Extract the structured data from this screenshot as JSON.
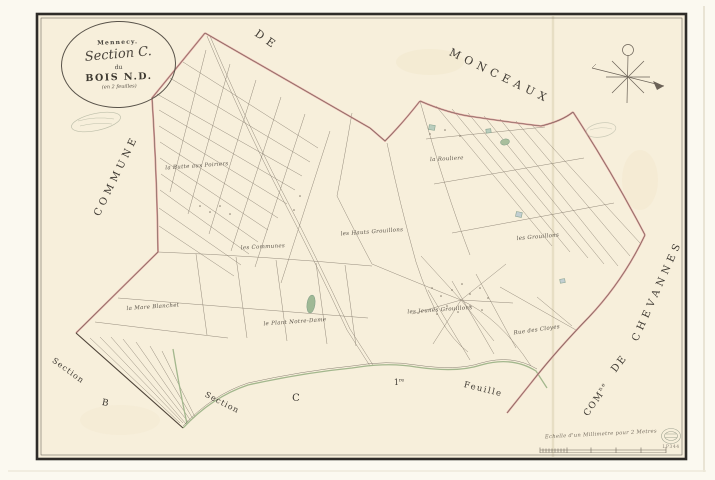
{
  "cartouche": {
    "commune": "Mennecy.",
    "section": "Section C.",
    "du": "du",
    "name": "BOIS N.D.",
    "note": "(en 2 feuilles)"
  },
  "neighbors": {
    "de_top": "DE",
    "monceaux": "MONCEAUX",
    "commune": "COMMUNE",
    "chevannes": "CHEVANNES",
    "de_right": "DE",
    "com_abbr": "COM",
    "com_sup": "ne"
  },
  "sections": {
    "section_b_word": "Section",
    "section_b_letter": "B",
    "section_c_word": "Section",
    "section_c_letter": "C",
    "feuille_ordinal": "1",
    "feuille_ordinal_sup": "re",
    "feuille_word": "Feuille"
  },
  "places": [
    "la Butte aux Poiriers",
    "la Rouliere",
    "les Hauts Grouillons",
    "les Grouillons",
    "les Communes",
    "la Mare Blanchet",
    "le Plant Notre-Dame",
    "les Jeunes Grouillons",
    "Rue des Cloyes"
  ],
  "scale": {
    "caption": "Echelle d'un Millimetre pour 2 Metres"
  },
  "stamp": {
    "code": "LP344"
  },
  "colors": {
    "boundary_pink": "#dc9494",
    "road_green": "#a3b78d",
    "ink": "#6f675b",
    "frame": "#2e2c28",
    "paper": "#f7efdb"
  }
}
